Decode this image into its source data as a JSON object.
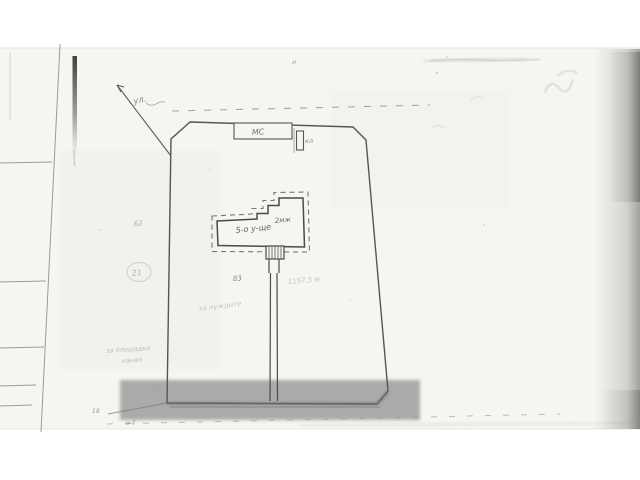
{
  "page": {
    "background": "#ffffff",
    "paper_tint": "#f5f5f2",
    "ink": "#4a4a4a",
    "type": "scanned cadastral site plan"
  },
  "plan": {
    "street": {
      "arrow_label": "ул."
    },
    "building": {
      "name_label": "5-о у-ще",
      "storeys_label": "2мж",
      "outbuilding_label": "МС",
      "utility_label": "кл"
    },
    "parcel_labels": {
      "plot_62": "62",
      "plot_83": "83",
      "circled_ref": "21",
      "corner_point": "18",
      "offset_mark": "о-2"
    },
    "faint_notes": {
      "area_note": "1157,5 м",
      "use_note": "за нуждите",
      "margin_note_line1": "за площадка",
      "margin_note_line2": "канал",
      "tiny_mark": "и"
    }
  }
}
